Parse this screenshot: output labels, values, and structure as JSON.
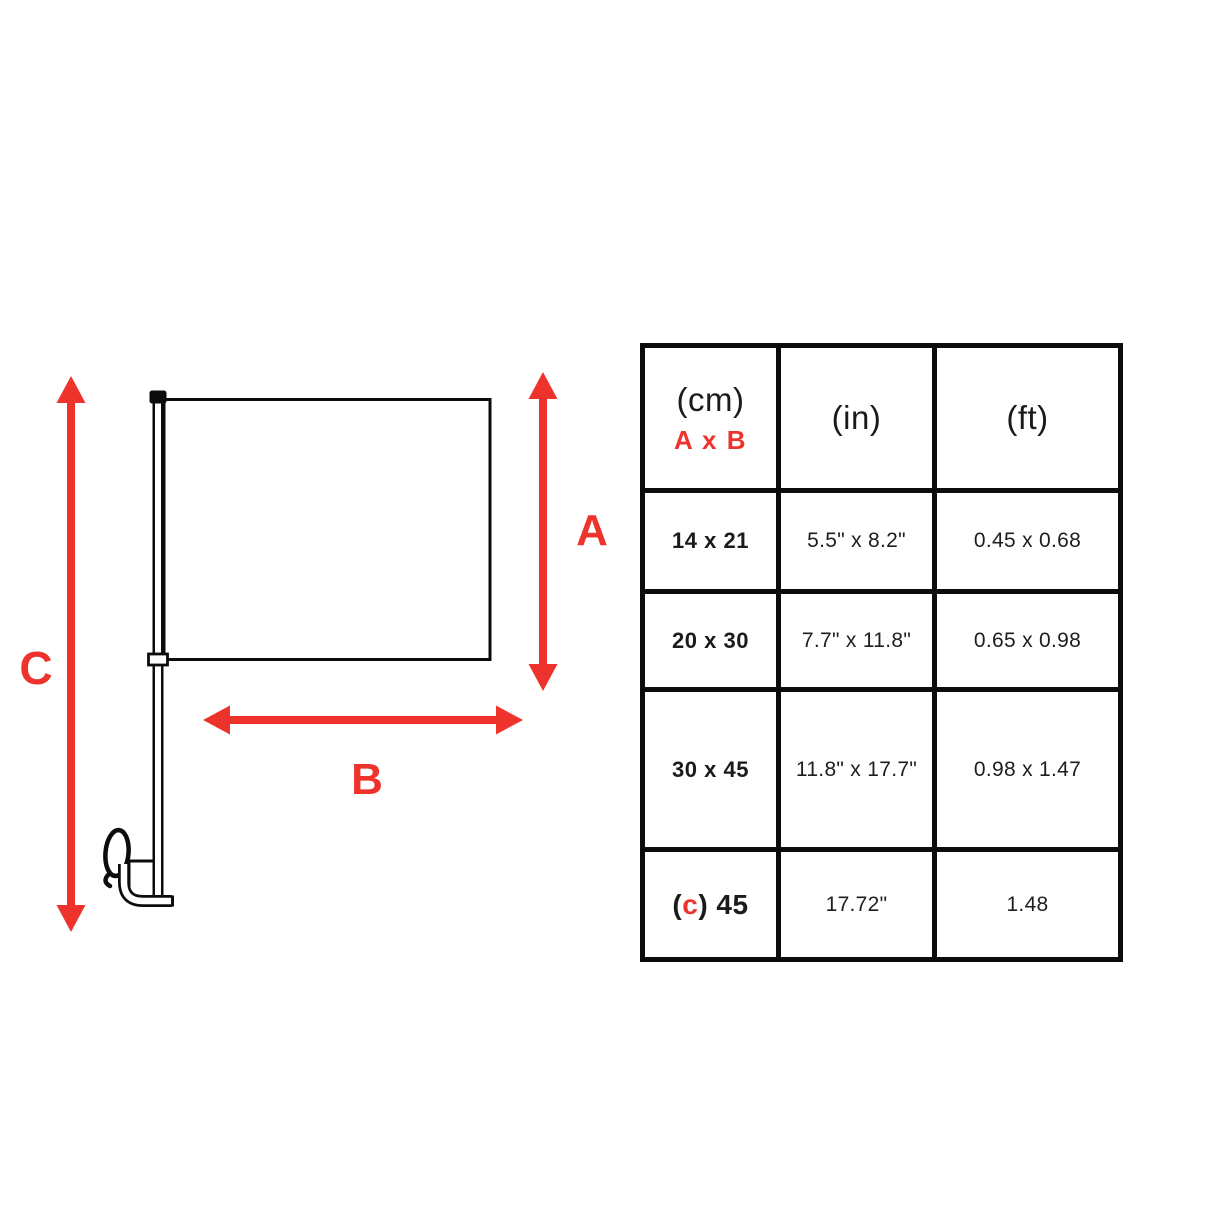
{
  "colors": {
    "accent_red": "#ee332d",
    "ink": "#0c0c0c"
  },
  "diagram": {
    "flag_height_label": "A",
    "flag_width_label": "B",
    "pole_height_label": "C"
  },
  "table": {
    "header": {
      "cm_unit": "(cm)",
      "cm_sub": "A x B",
      "in_unit": "(in)",
      "ft_unit": "(ft)"
    },
    "rows": [
      {
        "cm": "14 x 21",
        "in": "5.5\" x 8.2\"",
        "ft": "0.45 x 0.68"
      },
      {
        "cm": "20 x 30",
        "in": "7.7\" x 11.8\"",
        "ft": "0.65 x 0.98"
      },
      {
        "cm": "30 x 45",
        "in": "11.8\" x 17.7\"",
        "ft": "0.98 x 1.47"
      },
      {
        "cm_open": "(",
        "cm_c": "c",
        "cm_rest": ") 45",
        "in": "17.72\"",
        "ft": "1.48"
      }
    ]
  }
}
